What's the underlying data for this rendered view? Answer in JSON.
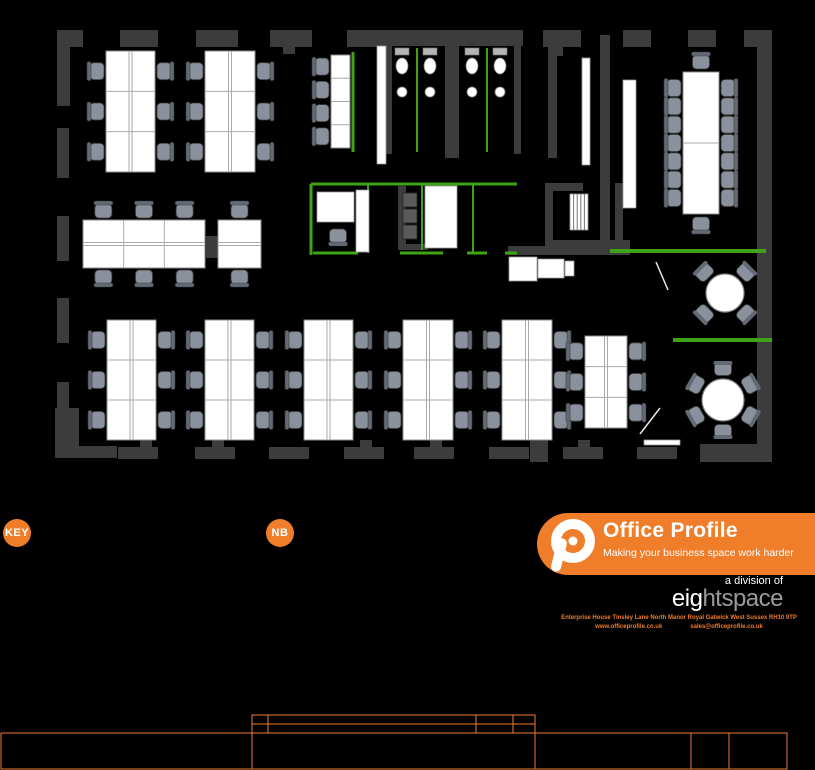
{
  "colors": {
    "background": "#000000",
    "wall": "#3c3c3c",
    "wall_light": "#5a5a5a",
    "desk": "#ffffff",
    "desk_stroke": "#8c8c8c",
    "chair": "#8a919d",
    "chair_back": "#646a75",
    "green": "#3fa318",
    "accent": "#ef7d2a",
    "parent_gray": "#9a9a9a"
  },
  "annotations": {
    "key_label": "KEY",
    "nb_label": "NB"
  },
  "logo": {
    "brand": "Office Profile",
    "tagline": "Making your business space work harder",
    "division": "a division of",
    "parent_white": "eig",
    "parent_gray": "htspace",
    "address": "Enterprise House   Tinsley Lane North   Manor Royal   Gatwick   West Sussex   RH10 9TP",
    "web": "www.officeprofile.co.uk",
    "email": "sales@officeprofile.co.uk"
  },
  "floorplan": {
    "walls": [
      [
        57,
        30,
        26,
        17
      ],
      [
        57,
        30,
        13,
        76
      ],
      [
        120,
        30,
        38,
        17
      ],
      [
        196,
        30,
        42,
        17
      ],
      [
        270,
        30,
        42,
        17
      ],
      [
        283,
        44,
        12,
        10
      ],
      [
        347,
        30,
        38,
        17
      ],
      [
        383,
        30,
        140,
        16
      ],
      [
        543,
        30,
        38,
        17
      ],
      [
        553,
        44,
        10,
        12
      ],
      [
        623,
        30,
        28,
        17
      ],
      [
        688,
        30,
        28,
        17
      ],
      [
        744,
        30,
        28,
        17
      ],
      [
        757,
        32,
        15,
        430
      ],
      [
        700,
        444,
        60,
        18
      ],
      [
        57,
        128,
        12,
        50
      ],
      [
        57,
        216,
        12,
        45
      ],
      [
        57,
        298,
        12,
        45
      ],
      [
        57,
        382,
        12,
        26
      ],
      [
        55,
        408,
        24,
        50
      ],
      [
        55,
        446,
        62,
        12
      ],
      [
        118,
        447,
        40,
        12
      ],
      [
        195,
        447,
        40,
        12
      ],
      [
        269,
        447,
        40,
        12
      ],
      [
        344,
        447,
        40,
        12
      ],
      [
        414,
        447,
        40,
        12
      ],
      [
        489,
        447,
        40,
        12
      ],
      [
        563,
        447,
        40,
        12
      ],
      [
        637,
        447,
        40,
        12
      ],
      [
        140,
        440,
        12,
        8
      ],
      [
        212,
        440,
        12,
        8
      ],
      [
        360,
        440,
        12,
        8
      ],
      [
        430,
        440,
        12,
        8
      ],
      [
        578,
        440,
        12,
        8
      ],
      [
        385,
        46,
        7,
        108
      ],
      [
        514,
        46,
        7,
        108
      ],
      [
        445,
        46,
        14,
        112
      ],
      [
        548,
        46,
        9,
        112
      ],
      [
        545,
        183,
        8,
        65
      ],
      [
        545,
        240,
        85,
        8
      ],
      [
        615,
        183,
        8,
        60
      ],
      [
        553,
        183,
        30,
        8
      ],
      [
        508,
        246,
        122,
        9
      ],
      [
        600,
        35,
        10,
        216
      ],
      [
        398,
        186,
        8,
        62
      ],
      [
        398,
        244,
        30,
        6
      ],
      [
        206,
        236,
        12,
        22
      ],
      [
        530,
        430,
        18,
        32
      ]
    ],
    "gray_rects": [
      [
        403,
        193,
        14,
        14
      ],
      [
        403,
        209,
        14,
        14
      ],
      [
        403,
        225,
        14,
        14
      ]
    ],
    "green_lines": [
      [
        353,
        52,
        353,
        152,
        3
      ],
      [
        417,
        48,
        417,
        152,
        2
      ],
      [
        487,
        48,
        487,
        152,
        2
      ],
      [
        311,
        184,
        517,
        184,
        3
      ],
      [
        311,
        184,
        311,
        255,
        3
      ],
      [
        368,
        184,
        368,
        253,
        2
      ],
      [
        422,
        184,
        422,
        250,
        2
      ],
      [
        473,
        184,
        473,
        253,
        2
      ],
      [
        313,
        253,
        358,
        253,
        3
      ],
      [
        400,
        253,
        443,
        253,
        3
      ],
      [
        467,
        253,
        487,
        253,
        3
      ],
      [
        505,
        253,
        517,
        253,
        3
      ],
      [
        610,
        251,
        766,
        251,
        4
      ],
      [
        673,
        340,
        772,
        340,
        4
      ]
    ],
    "white_rects": [
      [
        623,
        80,
        13,
        128
      ],
      [
        356,
        190,
        13,
        62
      ],
      [
        425,
        186,
        32,
        62
      ],
      [
        377,
        46,
        9,
        118
      ],
      [
        582,
        58,
        8,
        107
      ],
      [
        509,
        257,
        28,
        24
      ],
      [
        538,
        259,
        26,
        19
      ],
      [
        565,
        261,
        9,
        15
      ],
      [
        317,
        192,
        37,
        30
      ],
      [
        644,
        440,
        36,
        5
      ]
    ],
    "white_lines": [
      [
        656,
        262,
        668,
        290
      ],
      [
        640,
        434,
        660,
        408
      ]
    ],
    "stairs": {
      "x": 570,
      "y": 194,
      "w": 18,
      "h": 36,
      "steps": 4
    },
    "desk_banks": [
      {
        "x": 106,
        "y": 51,
        "w": 49,
        "h": 121,
        "rows": 3,
        "cols": 2,
        "orient": "v",
        "chairs": "both"
      },
      {
        "x": 205,
        "y": 51,
        "w": 50,
        "h": 121,
        "rows": 3,
        "cols": 2,
        "orient": "v",
        "chairs": "both"
      },
      {
        "x": 331,
        "y": 55,
        "w": 19,
        "h": 93,
        "rows": 4,
        "cols": 1,
        "orient": "v",
        "chairs": "left"
      },
      {
        "x": 83,
        "y": 220,
        "w": 122,
        "h": 48,
        "rows": 2,
        "cols": 3,
        "orient": "h",
        "chairs": "both"
      },
      {
        "x": 218,
        "y": 220,
        "w": 43,
        "h": 48,
        "rows": 2,
        "cols": 1,
        "orient": "h",
        "chairs": "both"
      },
      {
        "x": 107,
        "y": 320,
        "w": 49,
        "h": 120,
        "rows": 3,
        "cols": 2,
        "orient": "v",
        "chairs": "both"
      },
      {
        "x": 205,
        "y": 320,
        "w": 49,
        "h": 120,
        "rows": 3,
        "cols": 2,
        "orient": "v",
        "chairs": "both"
      },
      {
        "x": 304,
        "y": 320,
        "w": 49,
        "h": 120,
        "rows": 3,
        "cols": 2,
        "orient": "v",
        "chairs": "both"
      },
      {
        "x": 403,
        "y": 320,
        "w": 50,
        "h": 120,
        "rows": 3,
        "cols": 2,
        "orient": "v",
        "chairs": "both"
      },
      {
        "x": 502,
        "y": 320,
        "w": 50,
        "h": 120,
        "rows": 3,
        "cols": 2,
        "orient": "v",
        "chairs": "both"
      },
      {
        "x": 585,
        "y": 336,
        "w": 42,
        "h": 92,
        "rows": 3,
        "cols": 2,
        "orient": "v",
        "chairs": "both"
      }
    ],
    "extra_chairs": [
      [
        338,
        236,
        "d"
      ]
    ],
    "meeting": {
      "table": [
        683,
        72,
        36,
        142
      ],
      "side_chairs": 7,
      "credenza_gap": 0
    },
    "round_tables": [
      {
        "cx": 725,
        "cy": 293,
        "r": 19,
        "chairs": 4,
        "start": 45
      },
      {
        "cx": 723,
        "cy": 400,
        "r": 21,
        "chairs": 6,
        "start": 90
      }
    ],
    "toilets": {
      "centers": [
        402,
        430,
        472,
        500
      ],
      "cistern_y": 48,
      "bowl_y": 66,
      "basin_y": 92
    }
  },
  "titleblock": {
    "small_table": {
      "x1": 252,
      "y1": 715,
      "x2": 535,
      "y2": 733,
      "col_x": [
        268,
        476,
        513
      ],
      "row_y": [
        724
      ]
    },
    "main_rect": {
      "x1": 1,
      "y1": 733,
      "x2": 787,
      "y2": 769,
      "col_x": [
        252,
        535,
        691,
        729
      ]
    }
  }
}
